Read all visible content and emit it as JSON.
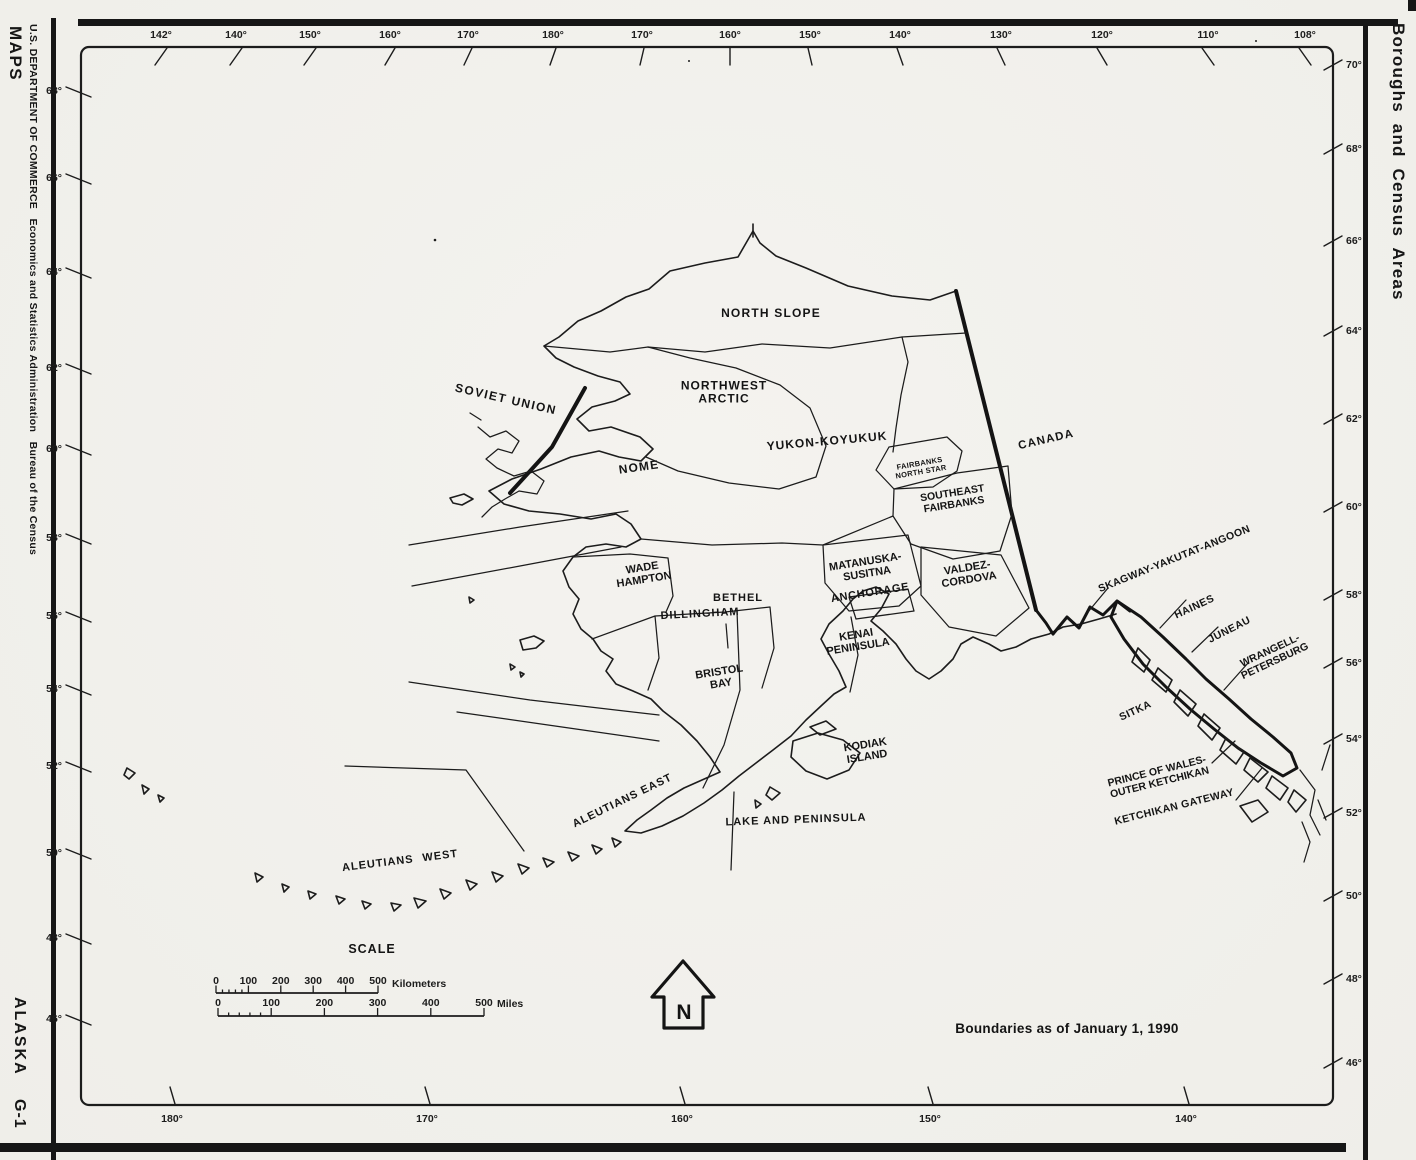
{
  "palette": {
    "ink": "#1c1c1c",
    "paper": "#f2f1ec"
  },
  "margin_left": {
    "agency_line": "U.S. DEPARTMENT OF COMMERCE   Economics and Statistics Administration   Bureau of the Census",
    "series": "MAPS",
    "state": "ALASKA",
    "sheet": "G-1"
  },
  "margin_right": {
    "title": "Boroughs and Census Areas"
  },
  "graticule": {
    "top": [
      {
        "label": "142°",
        "x": 161,
        "s": 6
      },
      {
        "label": "140°",
        "x": 236,
        "s": 6
      },
      {
        "label": "150°",
        "x": 310,
        "s": 6
      },
      {
        "label": "160°",
        "x": 390,
        "s": 5
      },
      {
        "label": "170°",
        "x": 468,
        "s": 4
      },
      {
        "label": "180°",
        "x": 553,
        "s": 3
      },
      {
        "label": "170°",
        "x": 642,
        "s": 2
      },
      {
        "label": "160°",
        "x": 730,
        "s": 0
      },
      {
        "label": "150°",
        "x": 810,
        "s": -2
      },
      {
        "label": "140°",
        "x": 900,
        "s": -3
      },
      {
        "label": "130°",
        "x": 1001,
        "s": -4
      },
      {
        "label": "120°",
        "x": 1102,
        "s": -5
      },
      {
        "label": "110°",
        "x": 1208,
        "s": -6
      },
      {
        "label": "108°",
        "x": 1305,
        "s": -6
      }
    ],
    "left": [
      {
        "label": "68°",
        "y": 90
      },
      {
        "label": "66°",
        "y": 177
      },
      {
        "label": "64°",
        "y": 271
      },
      {
        "label": "62°",
        "y": 367
      },
      {
        "label": "60°",
        "y": 448
      },
      {
        "label": "58°",
        "y": 537
      },
      {
        "label": "56°",
        "y": 615
      },
      {
        "label": "54°",
        "y": 688
      },
      {
        "label": "52°",
        "y": 765
      },
      {
        "label": "50°",
        "y": 852
      },
      {
        "label": "48°",
        "y": 937
      },
      {
        "label": "46°",
        "y": 1018
      }
    ],
    "right": [
      {
        "label": "70°",
        "y": 64
      },
      {
        "label": "68°",
        "y": 148
      },
      {
        "label": "66°",
        "y": 240
      },
      {
        "label": "64°",
        "y": 330
      },
      {
        "label": "62°",
        "y": 418
      },
      {
        "label": "60°",
        "y": 506
      },
      {
        "label": "58°",
        "y": 594
      },
      {
        "label": "56°",
        "y": 662
      },
      {
        "label": "54°",
        "y": 738
      },
      {
        "label": "52°",
        "y": 812
      },
      {
        "label": "50°",
        "y": 895
      },
      {
        "label": "48°",
        "y": 978
      },
      {
        "label": "46°",
        "y": 1062
      }
    ],
    "bottom": [
      {
        "label": "180°",
        "x": 172
      },
      {
        "label": "170°",
        "x": 427
      },
      {
        "label": "160°",
        "x": 682
      },
      {
        "label": "150°",
        "x": 930
      },
      {
        "label": "140°",
        "x": 1186
      }
    ]
  },
  "regions": [
    {
      "id": "soviet-union",
      "text": "SOVIET UNION",
      "x": 506,
      "y": 399,
      "rot": 13,
      "size": 12,
      "ls": 1.5
    },
    {
      "id": "north-slope",
      "text": "NORTH SLOPE",
      "x": 771,
      "y": 313,
      "rot": 0,
      "size": 12,
      "ls": 1.2
    },
    {
      "id": "northwest-arctic",
      "text": "NORTHWEST\nARCTIC",
      "x": 724,
      "y": 392,
      "rot": 0,
      "size": 12,
      "ls": 1,
      "lh": 13
    },
    {
      "id": "nome",
      "text": "NOME",
      "x": 639,
      "y": 467,
      "rot": -8,
      "size": 12,
      "ls": 1.2
    },
    {
      "id": "yukon-koyukuk",
      "text": "YUKON-KOYUKUK",
      "x": 827,
      "y": 441,
      "rot": -5,
      "size": 12,
      "ls": 1
    },
    {
      "id": "canada",
      "text": "CANADA",
      "x": 1046,
      "y": 439,
      "rot": -13,
      "size": 11.5,
      "ls": 1.2
    },
    {
      "id": "fairbanks-north-star",
      "text": "FAIRBANKS\nNORTH STAR",
      "x": 920,
      "y": 466,
      "rot": -10,
      "size": 7.5,
      "lh": 8.5,
      "ls": 0.3
    },
    {
      "id": "southeast-fairbanks",
      "text": "SOUTHEAST\nFAIRBANKS",
      "x": 953,
      "y": 498,
      "rot": -9,
      "size": 10.5,
      "lh": 11.5
    },
    {
      "id": "wade-hampton",
      "text": "WADE\nHAMPTON",
      "x": 643,
      "y": 573,
      "rot": -9,
      "size": 11,
      "lh": 12
    },
    {
      "id": "bethel",
      "text": "BETHEL",
      "x": 738,
      "y": 597,
      "rot": 0,
      "size": 11,
      "ls": 1
    },
    {
      "id": "dillingham",
      "text": "DILLINGHAM",
      "x": 700,
      "y": 613,
      "rot": -3,
      "size": 11,
      "ls": 1
    },
    {
      "id": "matanuska-susitna",
      "text": "MATANUSKA-\nSUSITNA",
      "x": 866,
      "y": 567,
      "rot": -9,
      "size": 11,
      "lh": 12
    },
    {
      "id": "anchorage",
      "text": "ANCHORAGE",
      "x": 870,
      "y": 592,
      "rot": -9,
      "size": 11,
      "ls": 0.8
    },
    {
      "id": "valdez-cordova",
      "text": "VALDEZ-\nCORDOVA",
      "x": 968,
      "y": 573,
      "rot": -9,
      "size": 11,
      "lh": 12
    },
    {
      "id": "kenai-peninsula",
      "text": "KENAI\nPENINSULA",
      "x": 857,
      "y": 640,
      "rot": -9,
      "size": 11,
      "lh": 12
    },
    {
      "id": "bristol-bay",
      "text": "BRISTOL\nBAY",
      "x": 720,
      "y": 677,
      "rot": -9,
      "size": 11,
      "lh": 12
    },
    {
      "id": "kodiak-island",
      "text": "KODIAK\nISLAND",
      "x": 866,
      "y": 750,
      "rot": -9,
      "size": 11,
      "lh": 12
    },
    {
      "id": "aleutians-east",
      "text": "ALEUTIANS EAST",
      "x": 622,
      "y": 800,
      "rot": -26,
      "size": 11,
      "ls": 1
    },
    {
      "id": "lake-and-peninsula",
      "text": "LAKE AND PENINSULA",
      "x": 796,
      "y": 819,
      "rot": -2,
      "size": 11,
      "ls": 1
    },
    {
      "id": "aleutians-west",
      "text": "ALEUTIANS WEST",
      "x": 400,
      "y": 860,
      "rot": -7,
      "size": 11,
      "ls": 1,
      "ws": 5
    },
    {
      "id": "skagway-yakutat-angoon",
      "text": "SKAGWAY-YAKUTAT-ANGOON",
      "x": 1174,
      "y": 558,
      "rot": -22,
      "size": 10.5,
      "ls": 0.4
    },
    {
      "id": "haines",
      "text": "HAINES",
      "x": 1194,
      "y": 606,
      "rot": -25,
      "size": 10.5,
      "ls": 0.5
    },
    {
      "id": "juneau",
      "text": "JUNEAU",
      "x": 1229,
      "y": 629,
      "rot": -27,
      "size": 10.5,
      "ls": 0.5
    },
    {
      "id": "wrangell-petersburg",
      "text": "WRANGELL-\nPETERSBURG",
      "x": 1272,
      "y": 655,
      "rot": -25,
      "size": 10.5,
      "lh": 11.5
    },
    {
      "id": "sitka",
      "text": "SITKA",
      "x": 1135,
      "y": 710,
      "rot": -25,
      "size": 10.5,
      "ls": 0.5
    },
    {
      "id": "prince-of-wales-outer-ketchikan",
      "text": "PRINCE OF WALES-\nOUTER KETCHIKAN",
      "x": 1158,
      "y": 776,
      "rot": -14,
      "size": 10.5,
      "lh": 11.5
    },
    {
      "id": "ketchikan-gateway",
      "text": "KETCHIKAN GATEWAY",
      "x": 1174,
      "y": 806,
      "rot": -14,
      "size": 10.5,
      "ls": 0.4
    }
  ],
  "scale": {
    "title": "SCALE",
    "km": {
      "ticks": [
        "0",
        "100",
        "200",
        "300",
        "400",
        "500"
      ],
      "unit": "Kilometers"
    },
    "mi": {
      "ticks": [
        "0",
        "100",
        "200",
        "300",
        "400",
        "500"
      ],
      "unit": "Miles"
    }
  },
  "north_arrow": {
    "label": "N"
  },
  "notes": {
    "boundaries": "Boundaries as of January 1, 1990"
  }
}
